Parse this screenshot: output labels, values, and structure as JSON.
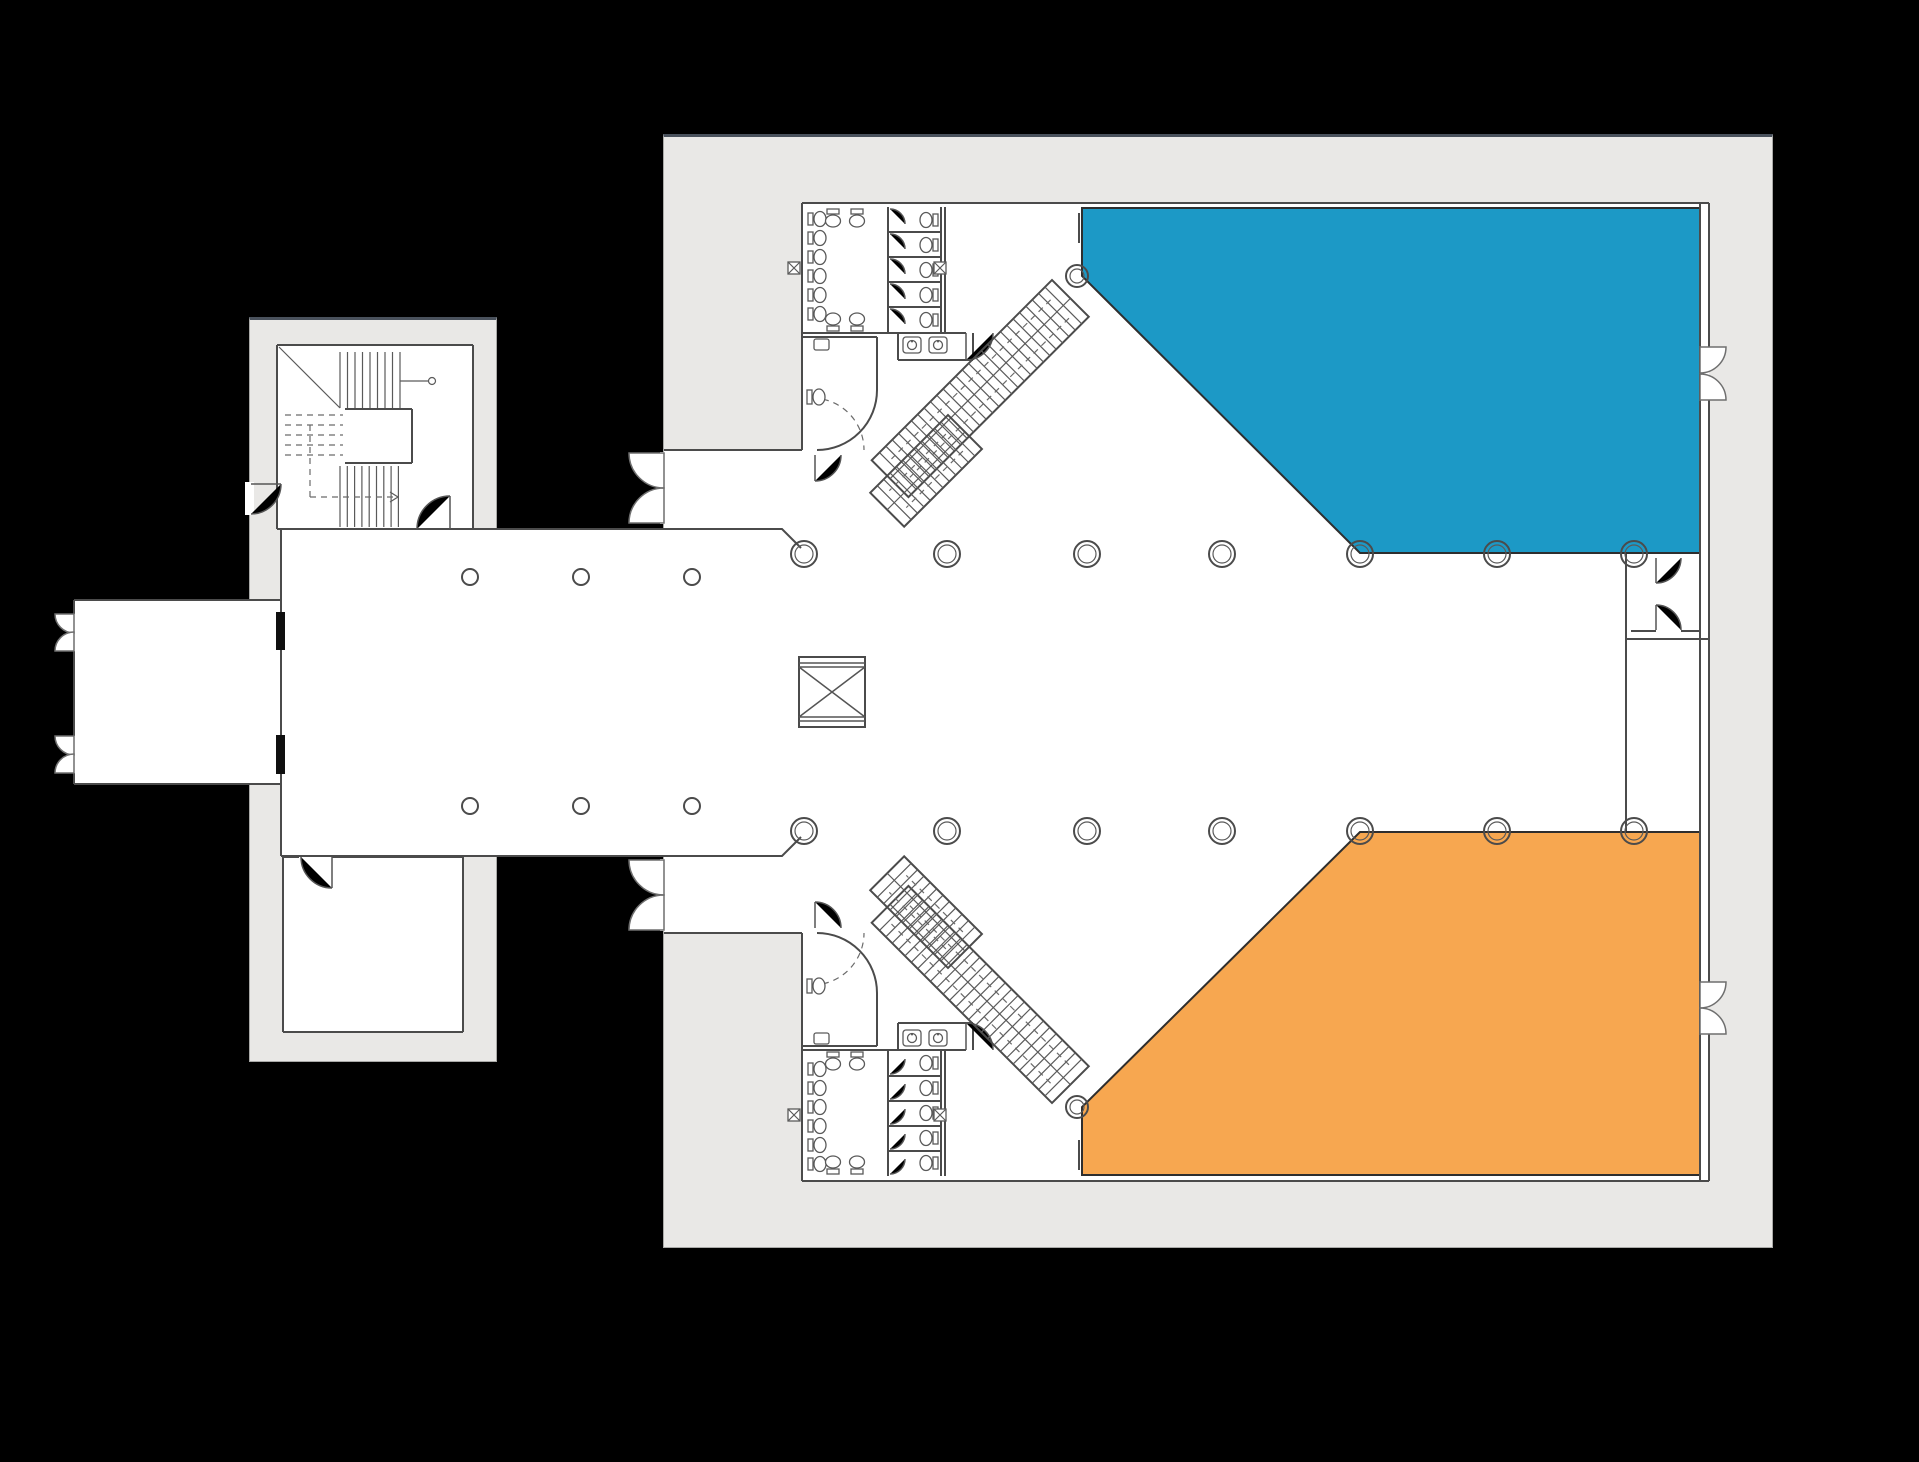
{
  "document": {
    "kind": "architectural-floor-plan",
    "background": "#000000"
  },
  "colors": {
    "background": "#000000",
    "shell": "#e9e8e6",
    "shell_edge_dark": "#49515c",
    "floor": "#ffffff",
    "wall_line": "#4b4b4b",
    "opening_dark": "#0f0f0f"
  },
  "regions": {
    "upper_hall": {
      "shape": "pentagon",
      "fill": "#1c99c6"
    },
    "lower_hall": {
      "shape": "pentagon",
      "fill": "#f7a750"
    }
  },
  "plan_facts": {
    "large_columns": 16,
    "small_columns": 6,
    "toilet_stalls_per_block": 5,
    "diagonal_stairs": 2,
    "exterior_double_doors": 6,
    "annex_stair_rooms": 1
  }
}
